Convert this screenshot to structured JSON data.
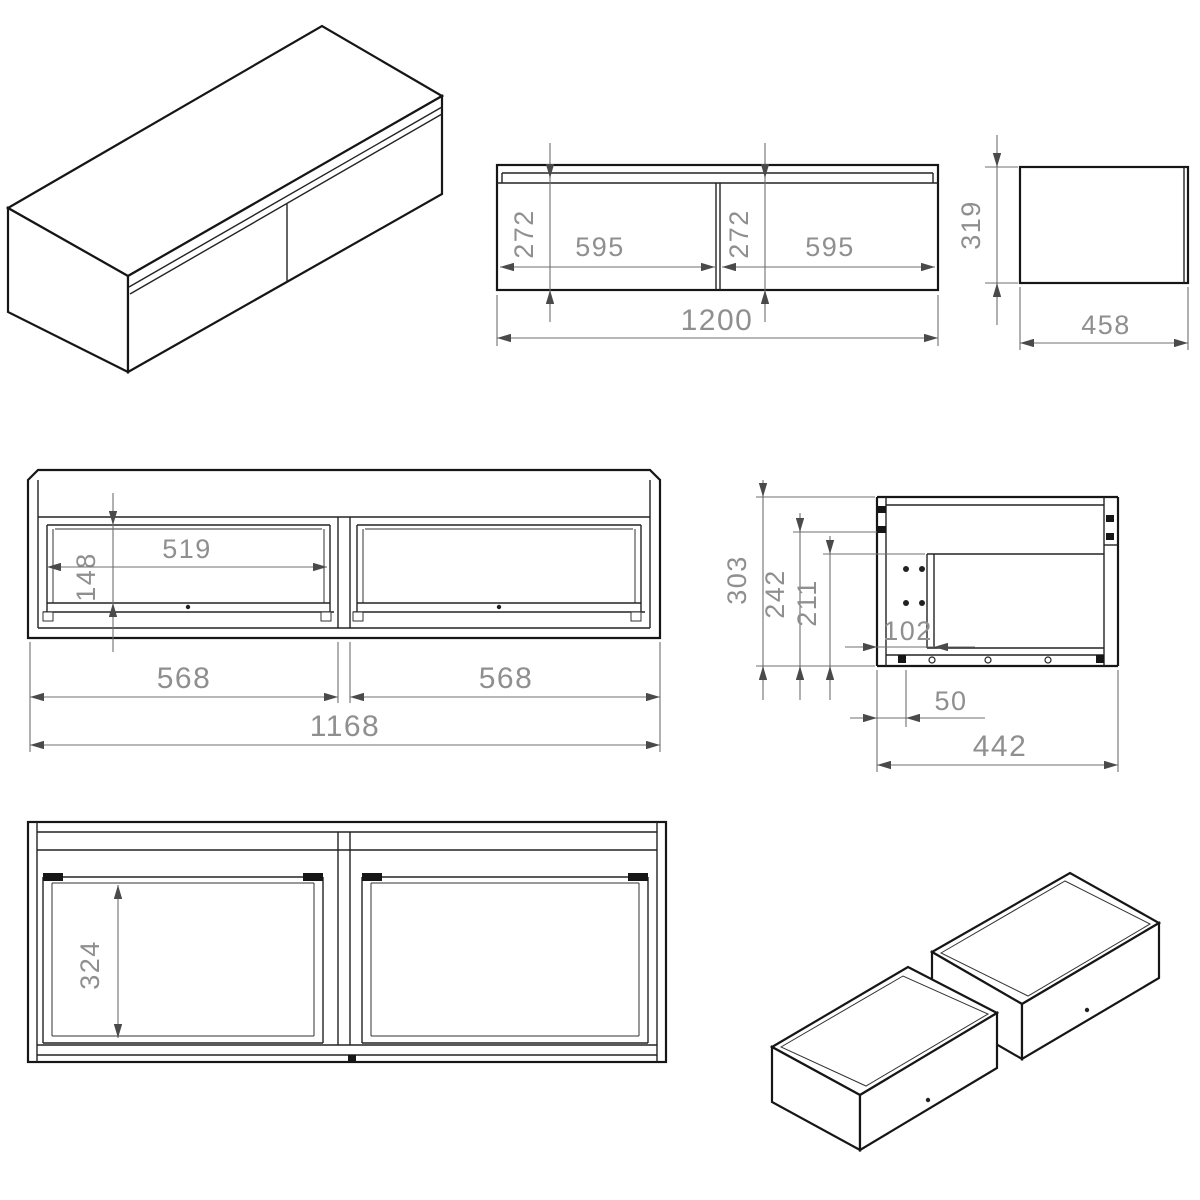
{
  "drawing": {
    "views": {
      "front": {
        "drawer_height_left": "272",
        "drawer_width_left": "595",
        "drawer_height_right": "272",
        "drawer_width_right": "595",
        "total_width": "1200"
      },
      "side": {
        "height": "319",
        "depth": "458"
      },
      "carcass_front": {
        "clear_width": "519",
        "clear_height": "148",
        "opening_width_left": "568",
        "opening_width_right": "568",
        "inner_width": "1168"
      },
      "carcass_side": {
        "total_height": "303",
        "back_height": "242",
        "inner_height": "211",
        "back_offset": "102",
        "bottom_offset": "50",
        "depth": "442"
      },
      "plan": {
        "inner_depth": "324"
      }
    }
  }
}
